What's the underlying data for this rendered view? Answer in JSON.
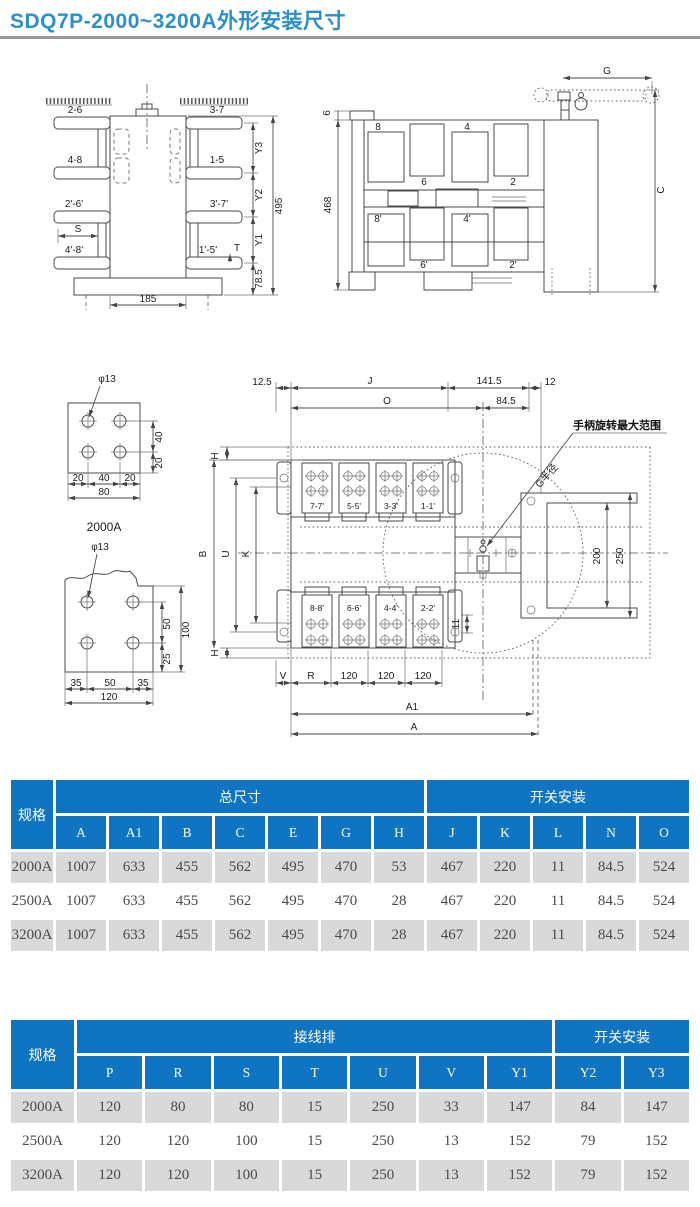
{
  "title": "SDQ7P-2000~3200A外形安装尺寸",
  "dwg": {
    "side": {
      "a26": "2-6",
      "a37": "3-7",
      "a48": "4-8",
      "a15": "1-5",
      "b26": "2'-6'",
      "b37": "3'-7'",
      "b48": "4'-8'",
      "b15": "1'-5'",
      "s": "S",
      "t": "T",
      "y1": "Y1",
      "y2": "Y2",
      "y3": "Y3",
      "h495": "495",
      "h785": "78.5",
      "w185": "185"
    },
    "front": {
      "p8": "8",
      "p6": "6",
      "p4": "4",
      "p2": "2",
      "q8": "8'",
      "q6": "6'",
      "q4": "4'",
      "q2": "2'",
      "h468": "468",
      "h6": "6",
      "g": "G",
      "c": "C"
    },
    "pt": {
      "phi": "φ13",
      "v40": "40",
      "v20": "20",
      "h20": "20",
      "h40": "40",
      "h80": "80",
      "name": "2000A"
    },
    "pb": {
      "phi": "φ13",
      "v50": "50",
      "v25": "25",
      "v100": "100",
      "h35": "35",
      "h50": "50",
      "h120": "120"
    },
    "main": {
      "d125": "12.5",
      "j": "J",
      "d1415": "141.5",
      "d12": "12",
      "o": "O",
      "d845": "84.5",
      "note": "手柄旋转最大范围",
      "gr": "G半径",
      "h": "H",
      "b": "B",
      "u": "U",
      "k": "K",
      "v": "V",
      "r": "R",
      "d120": "120",
      "a1": "A1",
      "a": "A",
      "d200": "200",
      "d250": "250",
      "d11": "11",
      "t77": "7-7'",
      "t55": "5-5'",
      "t33": "3-3'",
      "t11": "1-1'",
      "t88": "8-8'",
      "t66": "6-6'",
      "t44": "4-4'",
      "t22": "2-2'"
    }
  },
  "table1": {
    "spec_header": "规格",
    "groups": [
      {
        "label": "总尺寸",
        "span": 7
      },
      {
        "label": "开关安装",
        "span": 5
      }
    ],
    "columns": [
      "A",
      "A1",
      "B",
      "C",
      "E",
      "G",
      "H",
      "J",
      "K",
      "L",
      "N",
      "O"
    ],
    "rows": [
      {
        "spec": "2000A",
        "values": [
          "1007",
          "633",
          "455",
          "562",
          "495",
          "470",
          "53",
          "467",
          "220",
          "11",
          "84.5",
          "524"
        ]
      },
      {
        "spec": "2500A",
        "values": [
          "1007",
          "633",
          "455",
          "562",
          "495",
          "470",
          "28",
          "467",
          "220",
          "11",
          "84.5",
          "524"
        ]
      },
      {
        "spec": "3200A",
        "values": [
          "1007",
          "633",
          "455",
          "562",
          "495",
          "470",
          "28",
          "467",
          "220",
          "11",
          "84.5",
          "524"
        ]
      }
    ]
  },
  "table2": {
    "spec_header": "规格",
    "groups": [
      {
        "label": "接线排",
        "span": 7
      },
      {
        "label": "开关安装",
        "span": 2
      }
    ],
    "columns": [
      "P",
      "R",
      "S",
      "T",
      "U",
      "V",
      "Y1",
      "Y2",
      "Y3"
    ],
    "rows": [
      {
        "spec": "2000A",
        "values": [
          "120",
          "80",
          "80",
          "15",
          "250",
          "33",
          "147",
          "84",
          "147"
        ]
      },
      {
        "spec": "2500A",
        "values": [
          "120",
          "120",
          "100",
          "15",
          "250",
          "13",
          "152",
          "79",
          "152"
        ]
      },
      {
        "spec": "3200A",
        "values": [
          "120",
          "120",
          "100",
          "15",
          "250",
          "13",
          "152",
          "79",
          "152"
        ]
      }
    ]
  }
}
